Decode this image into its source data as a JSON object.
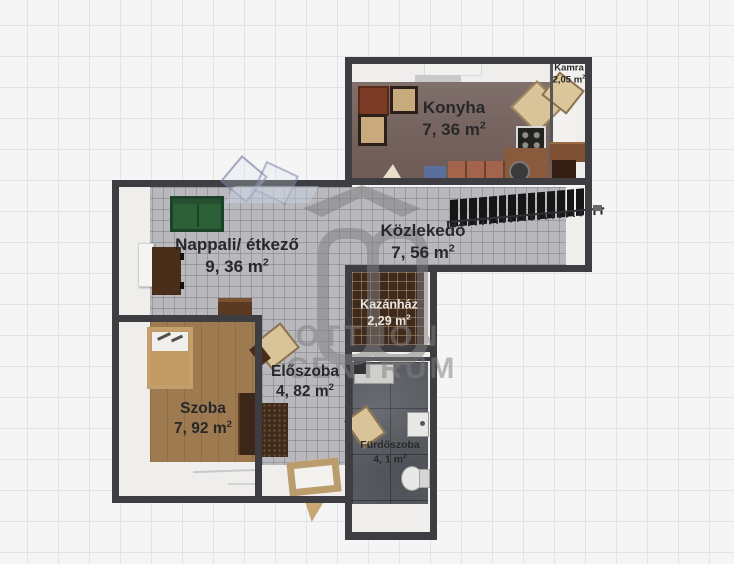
{
  "plan": {
    "rooms": {
      "konyha": {
        "name": "Konyha",
        "area": "7, 36 m",
        "sup": "2"
      },
      "kamra": {
        "name": "Kamra",
        "area": "2,05 m",
        "sup": "2"
      },
      "nappali": {
        "name": "Nappali/ étkező",
        "area": "9, 36 m",
        "sup": "2"
      },
      "kozlekedo": {
        "name": "Közlekedő",
        "area": "7, 56 m",
        "sup": "2"
      },
      "kazanhaz": {
        "name": "Kazánház",
        "area": "2,29 m",
        "sup": "2"
      },
      "eloszoba": {
        "name": "Előszoba",
        "area": "4, 82 m",
        "sup": "2"
      },
      "szoba": {
        "name": "Szoba",
        "area": "7, 92 m",
        "sup": "2"
      },
      "furdoszoba": {
        "name": "Fürdőszoba",
        "area": "4, 1 m",
        "sup": "2"
      }
    },
    "watermark": {
      "initials": "OC",
      "line1": "OTTHON",
      "line2": "CENTRUM"
    },
    "colors": {
      "wall": "#3e3e42",
      "tile_floor": "#b8b8bd",
      "wood_floor": "#9d7a4f",
      "kitchen_floor": "#7c6b67",
      "bath_tile": "#585c62",
      "boiler_tile": "#3f2b1e",
      "sofa_green": "#2c5f35",
      "background_grid": "#f5f5f6"
    }
  }
}
